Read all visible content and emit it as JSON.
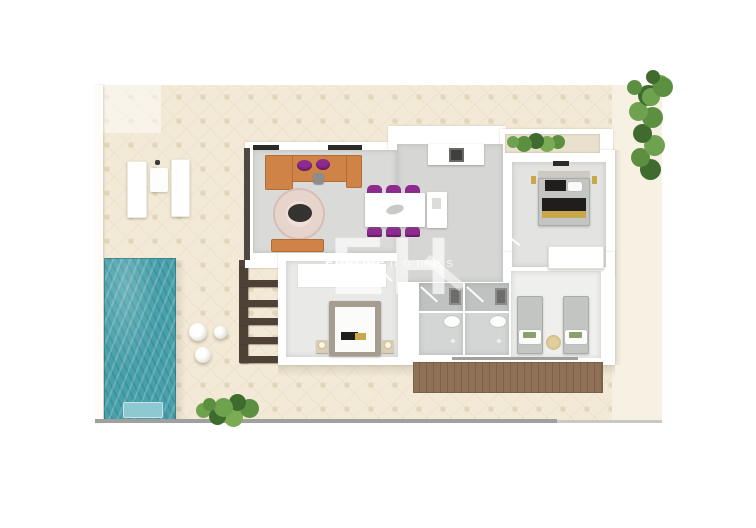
{
  "watermark": {
    "monogram": "EH",
    "brand_bold": "EUROPE",
    "brand_light": "homes"
  },
  "palette": {
    "terrace": "#f2e9d6",
    "terrace-light": "#f7f1e4",
    "wall": "#ffffff",
    "floor": "#dadad8",
    "floor-light": "#e9e9e7",
    "pool": "#47a0aa",
    "pool-light": "#8ec9d1",
    "sofa": "#cf8347",
    "purple": "#8e2b8f",
    "rug": "#e7d4cc",
    "dark": "#35332f",
    "deck": "#8f7157",
    "deck-line": "#7d614a",
    "pergola": "#4e4237",
    "green": "#5d8f41",
    "green-dark": "#3f6b2f",
    "sand": "#e2cf9e",
    "gold": "#c9a84c",
    "black": "#1f1e1c",
    "gray-bed": "#c2c5c2",
    "taupe": "#a69d90",
    "shadow-line": "#a0a09e"
  },
  "scene": {
    "type": "3d-top-view-floor-plan",
    "outdoor_items": [
      "terrace",
      "swimming-pool",
      "pool-step",
      "sun-loungers",
      "side-table",
      "round-poufs",
      "pergola",
      "wood-deck",
      "hedge",
      "potted-plant",
      "planter-box"
    ],
    "rooms": [
      {
        "name": "living-room",
        "items": [
          "corner-sofa",
          "purple-cushions",
          "round-rug",
          "coffee-table",
          "bench",
          "side-table"
        ]
      },
      {
        "name": "kitchen-dining",
        "items": [
          "dining-table",
          "six-purple-chairs",
          "kitchen-island",
          "kitchen-counter",
          "sink"
        ]
      },
      {
        "name": "bedroom-right",
        "items": [
          "double-bed",
          "black-gold-bedding",
          "wall-lamps",
          "dresser"
        ]
      },
      {
        "name": "bedroom-master",
        "items": [
          "double-bed",
          "nightstands",
          "closet"
        ]
      },
      {
        "name": "bathroom-1",
        "items": [
          "shower",
          "toilet",
          "drain"
        ]
      },
      {
        "name": "bathroom-2",
        "items": [
          "shower",
          "toilet",
          "drain"
        ]
      },
      {
        "name": "bedroom-twin",
        "items": [
          "single-bed",
          "single-bed",
          "round-rug"
        ]
      }
    ]
  }
}
